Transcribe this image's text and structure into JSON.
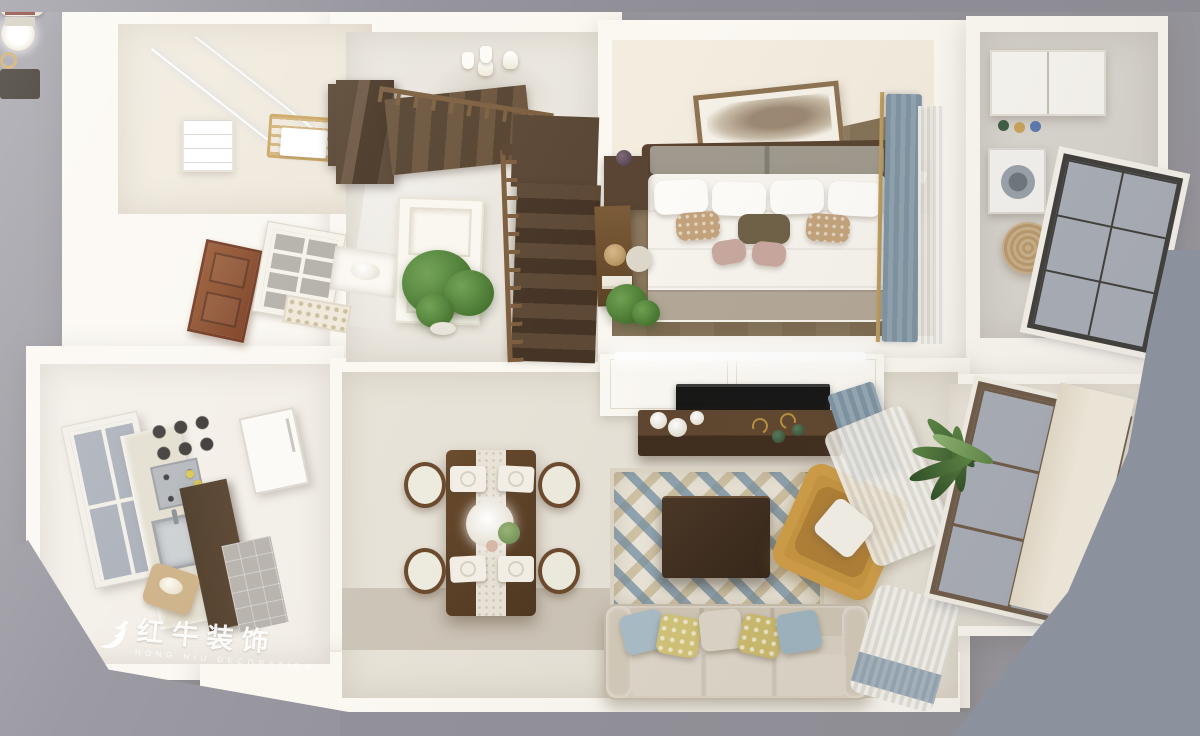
{
  "watermark": {
    "brand": "红牛装饰",
    "subtitle": "HONG NIU DECORATION"
  },
  "palette": {
    "background": "#98979f",
    "background_right": "#8e96a4",
    "strip_top": "#8f8e97",
    "strip_bottom": "#92919a",
    "wall": "#fbf8f2",
    "wall_cream": "#f3ecdf",
    "tile_warm": "#efe8db",
    "tile_cool": "#e7e2d7",
    "tile_gloss": "#eae6de",
    "tile_taupe": "#ccc4b7",
    "tile_gray": "#d9d6d0",
    "wood_floor": "#8f7c62",
    "wood_dark": "#4a3826",
    "wood_mid": "#6b513a",
    "wood_rail": "#7c5e3e",
    "door_wood": "#8c4a2a",
    "glass": "#a9aeb8",
    "frame_dark": "#3f3e3c",
    "frame_bronze": "#6e5b49",
    "curtain_blue": "#7e93a2",
    "sheer": "#f2f1ec",
    "headboard": "#a09a8e",
    "blanket": "#b3a898",
    "sofa": "#d8d0c2",
    "rug_blue": "#6e8ca3",
    "rug_tan": "#bfad83",
    "rug_base": "#eae5d8",
    "armchair": "#c6953f",
    "pillow_blue": "#a9bcc7",
    "pillow_yellow": "#d2c377",
    "plant": "#4c7a38",
    "gold": "#c9a35c",
    "tv": "#161616",
    "white": "#ffffff"
  },
  "scene": {
    "type": "3d-isometric-floorplan-render",
    "rooms": [
      {
        "name": "bathroom",
        "position": "top-left",
        "furniture": [
          "glass-shower",
          "towel-rack",
          "towel",
          "shelf-unit",
          "vanity-cabinet"
        ]
      },
      {
        "name": "entry-hall",
        "position": "left-middle",
        "furniture": [
          "wood-entry-door",
          "mullioned-window",
          "mosaic-backsplash",
          "display-niche"
        ]
      },
      {
        "name": "stair-hall",
        "position": "top-center",
        "furniture": [
          "staircase-upper-flight",
          "staircase-lower-flight",
          "wood-railing",
          "under-stair-door",
          "potted-plant",
          "wall-sconces",
          "hall-cabinet",
          "vases"
        ]
      },
      {
        "name": "bedroom",
        "position": "top-right",
        "furniture": [
          "double-bed",
          "headboard",
          "white-pillows",
          "accent-pillows",
          "wall-art",
          "nightstand-left",
          "nightstand-right",
          "desk",
          "desk-chair",
          "plant",
          "blue-curtain",
          "sheer-curtain",
          "gold-curtain-rod",
          "throw-blanket"
        ]
      },
      {
        "name": "laundry-room",
        "position": "far-right-top",
        "furniture": [
          "wall-cabinet",
          "washing-machine",
          "round-rattan-chair",
          "large-window",
          "jars"
        ]
      },
      {
        "name": "kitchen",
        "position": "bottom-left",
        "furniture": [
          "window",
          "counter",
          "sink",
          "stove",
          "lemons",
          "wall-jars",
          "dark-base-cabinet",
          "fridge",
          "gray-wall-tile",
          "cutting-board",
          "bread"
        ]
      },
      {
        "name": "dining-room",
        "position": "bottom-center-left",
        "furniture": [
          "dining-table",
          "table-runner",
          "floral-centerpiece",
          "place-mats",
          "four-chairs"
        ]
      },
      {
        "name": "living-room",
        "position": "bottom-center-right",
        "furniture": [
          "tv",
          "tv-panel-wall",
          "led-light-strip",
          "tv-console",
          "decor-plates",
          "decor-bottles",
          "geometric-rug",
          "coffee-table",
          "coral-decor",
          "book-tray",
          "armchair",
          "armchair-pillow",
          "sofa",
          "sofa-pillows",
          "blue-curtain",
          "sheer-curtains",
          "palm-plant"
        ]
      },
      {
        "name": "balcony",
        "position": "bottom-right",
        "furniture": [
          "floor-to-ceiling-window",
          "pillar"
        ]
      }
    ]
  }
}
